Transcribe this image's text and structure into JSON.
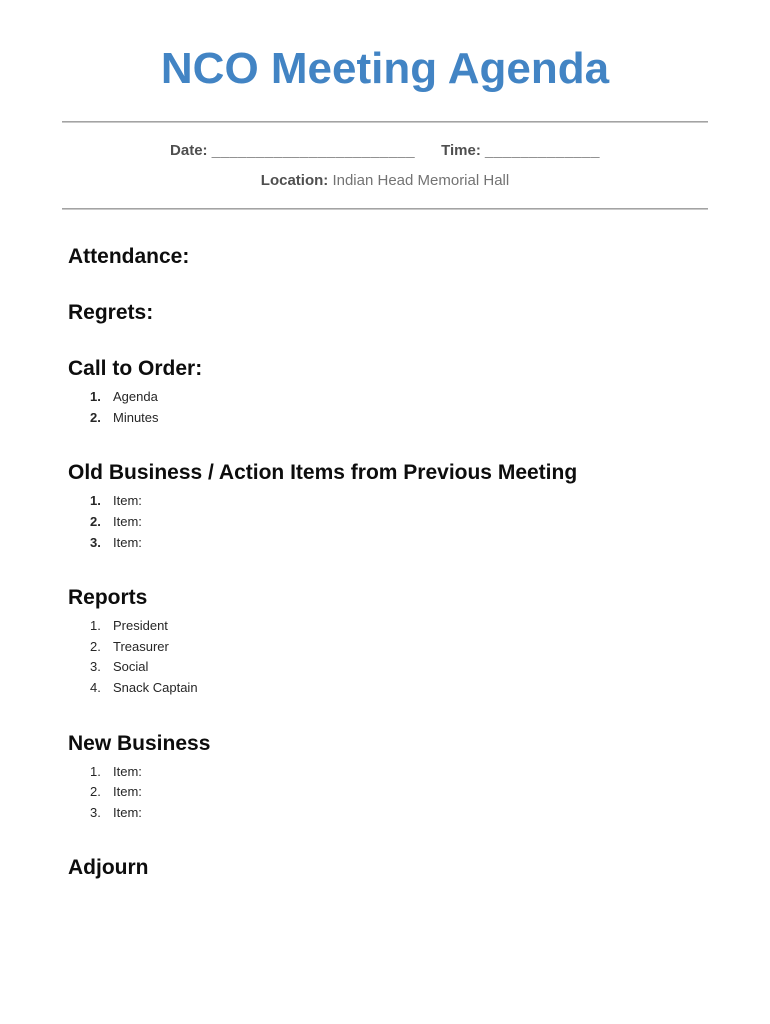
{
  "document": {
    "title": "NCO Meeting Agenda",
    "header": {
      "date_label": "Date:",
      "date_blank": "_______________________",
      "time_label": "Time:",
      "time_blank": "_____________",
      "location_label": "Location:",
      "location_value": "Indian Head Memorial Hall"
    },
    "sections": [
      {
        "heading": "Attendance:",
        "bold_numbers": false,
        "items": []
      },
      {
        "heading": "Regrets:",
        "bold_numbers": false,
        "items": []
      },
      {
        "heading": "Call to Order:",
        "bold_numbers": true,
        "items": [
          "Agenda",
          "Minutes"
        ]
      },
      {
        "heading": "Old Business / Action Items from Previous Meeting",
        "bold_numbers": true,
        "items": [
          "Item:",
          "Item:",
          "Item:"
        ]
      },
      {
        "heading": "Reports",
        "bold_numbers": false,
        "items": [
          "President",
          "Treasurer",
          "Social",
          "Snack Captain"
        ]
      },
      {
        "heading": "New Business",
        "bold_numbers": false,
        "items": [
          "Item:",
          "Item:",
          "Item:"
        ]
      },
      {
        "heading": "Adjourn",
        "bold_numbers": false,
        "items": []
      }
    ],
    "footer": {
      "brand": "Meeting Agenda Templates",
      "separator": "|",
      "copyright": "©2019 by Vertex42.com",
      "url": "https://www.vertex42.com/WordTemplates/meeting-agenda.html"
    },
    "colors": {
      "title_blue": "#4284c4",
      "rule_gray": "#a3a3a3",
      "meta_gray": "#595959",
      "footer_gray": "#8c8c8c"
    }
  }
}
